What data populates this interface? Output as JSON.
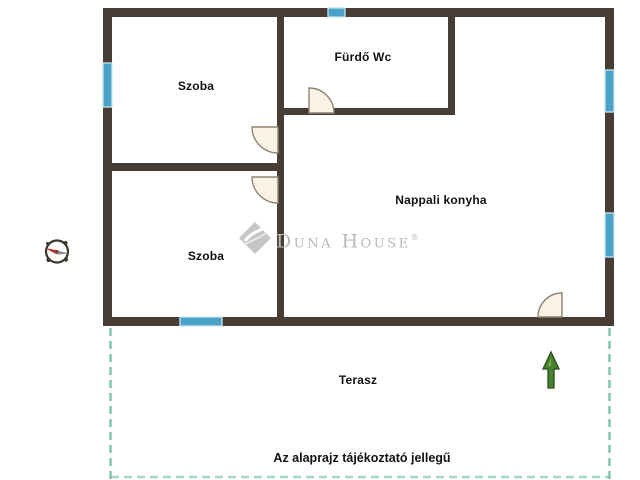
{
  "plan": {
    "rooms": [
      {
        "id": "szoba-top",
        "label": "Szoba"
      },
      {
        "id": "furdo-wc",
        "label": "Fürdő Wc"
      },
      {
        "id": "nappali-konyha",
        "label": "Nappali konyha"
      },
      {
        "id": "szoba-bottom",
        "label": "Szoba"
      },
      {
        "id": "terasz",
        "label": "Terasz"
      }
    ],
    "disclaimer": "Az alaprajz tájékoztató jellegű"
  },
  "watermark": {
    "brand": "Duna House",
    "registered": "®",
    "logo_icon": "duna-house-diamond-logo"
  },
  "icons": {
    "compass": "compass-rose-icon",
    "north_arrow": "north-arrow-icon"
  },
  "colors": {
    "wall": "#473d35",
    "window": "#4aa2c9",
    "window_border": "#c9e4ee",
    "door_fill": "#faf3e3",
    "door_stroke": "#8d8374",
    "terrace_dash": "#86c7b6",
    "watermark_gray": "#b9b9b9",
    "north_arrow_green": "#47822e",
    "compass_needle_red": "#b43328",
    "label_text": "#111111",
    "background": "#ffffff"
  }
}
